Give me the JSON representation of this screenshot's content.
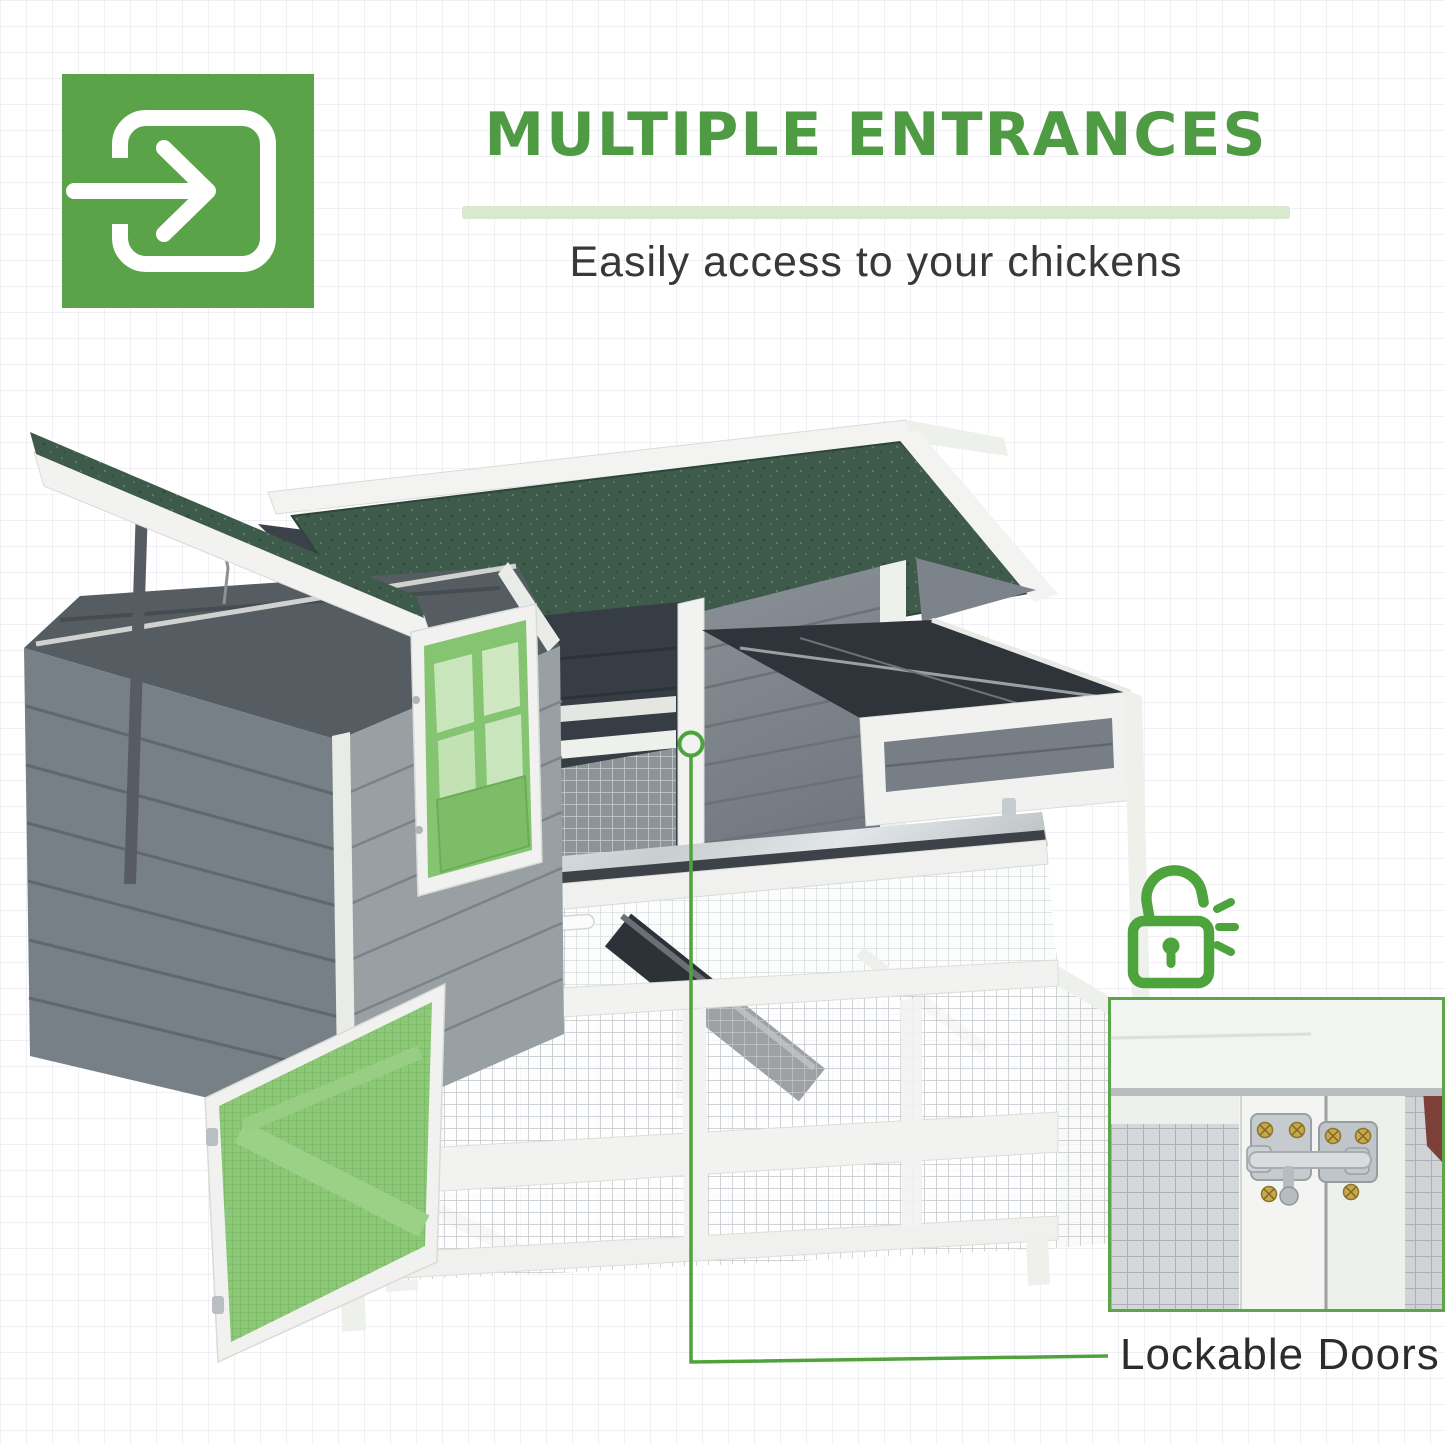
{
  "header": {
    "icon": "enter-arrow-icon",
    "title": "MULTIPLE ENTRANCES",
    "subtitle": "Easily access to your chickens"
  },
  "annotation": {
    "lock_icon": "unlocked-padlock-icon",
    "marker": "door-latch-marker-circle",
    "label": "Lockable Doors"
  },
  "illustration": {
    "subject": "grey and white chicken coop with green asphalt roof, open nesting-box lid, open green entry door, open green mesh run door, pull-out tray and wire mesh run",
    "inset": "close-up of metal barrel-bolt door latch on white frame"
  },
  "colors": {
    "tile_green": "#5ba348",
    "title_green": "#4f9b43",
    "divider_green": "#d8e9d0",
    "annotation_green": "#4ea43c",
    "roof_green": "#3e5a4a",
    "door_green": "#85c471",
    "mesh_door_green": "#8cc878",
    "text_dark": "#383838"
  }
}
